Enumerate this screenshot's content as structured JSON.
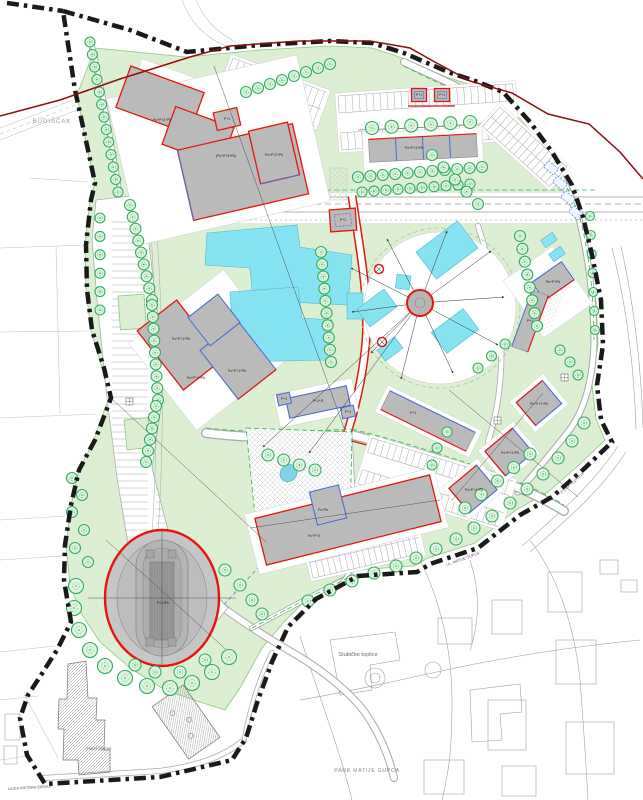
{
  "map": {
    "type": "urban-site-plan",
    "area_labels": {
      "budiscak": "BUDIŠČAK",
      "topliscak": "TOPLIŠČAK",
      "stubicke_toplice": "Stubičke toplice",
      "park_matije_gupca": "PARK MATIJE GUPCA",
      "hotel_sljeme": "Hotel Sljeme"
    },
    "street_labels": {
      "ulica_viktora_sipeka": "ULICA VIKTORA ŠIPEKA",
      "ul_matije_gupca": "UL. MATIJE GUPCA",
      "potok_toplicina": "Potok Topličina"
    },
    "building_labels": [
      {
        "text": "Po+P+2+Pk",
        "x": 162,
        "y": 121
      },
      {
        "text": "(Po+P+3+Pk)",
        "x": 226,
        "y": 157
      },
      {
        "text": "Po+P+2+Pk",
        "x": 274,
        "y": 156
      },
      {
        "text": "P+1",
        "x": 227,
        "y": 120
      },
      {
        "text": "Po+P+1+Pk",
        "x": 414,
        "y": 149
      },
      {
        "text": "P+1",
        "x": 419,
        "y": 96
      },
      {
        "text": "P+1",
        "x": 442,
        "y": 96
      },
      {
        "text": "P+1",
        "x": 343,
        "y": 221
      },
      {
        "text": "Po+P+1+Pk",
        "x": 181,
        "y": 340
      },
      {
        "text": "Po+P+1+Pk",
        "x": 196,
        "y": 379
      },
      {
        "text": "Po+P+1+Pk",
        "x": 237,
        "y": 372
      },
      {
        "text": "P+1+R",
        "x": 318,
        "y": 402
      },
      {
        "text": "P+1",
        "x": 284,
        "y": 400
      },
      {
        "text": "P+1",
        "x": 348,
        "y": 413
      },
      {
        "text": "P+1",
        "x": 413,
        "y": 414
      },
      {
        "text": "Po+P+Pk",
        "x": 553,
        "y": 283
      },
      {
        "text": "P+1",
        "x": 530,
        "y": 322
      },
      {
        "text": "Po+P+1+Pk",
        "x": 539,
        "y": 405
      },
      {
        "text": "Po+P+1+Pk",
        "x": 510,
        "y": 454
      },
      {
        "text": "Po+P+1+Pk",
        "x": 474,
        "y": 491
      },
      {
        "text": "Po+Pk",
        "x": 323,
        "y": 511
      },
      {
        "text": "Po+P+2",
        "x": 314,
        "y": 537
      },
      {
        "text": "Po+2Pk",
        "x": 163,
        "y": 604
      }
    ],
    "colors": {
      "boundary": "#1a1a1a",
      "municipal_line": "#8f0d0d",
      "new_building_outline_red": "#e8150d",
      "cadastral_blue": "#4a6fd4",
      "building_gray": "#bababa",
      "green_fill": "#dcefd2",
      "green_edge": "#8cc87f",
      "tree_green": "#2fae62",
      "pool_cyan": "#85e3f2"
    }
  }
}
